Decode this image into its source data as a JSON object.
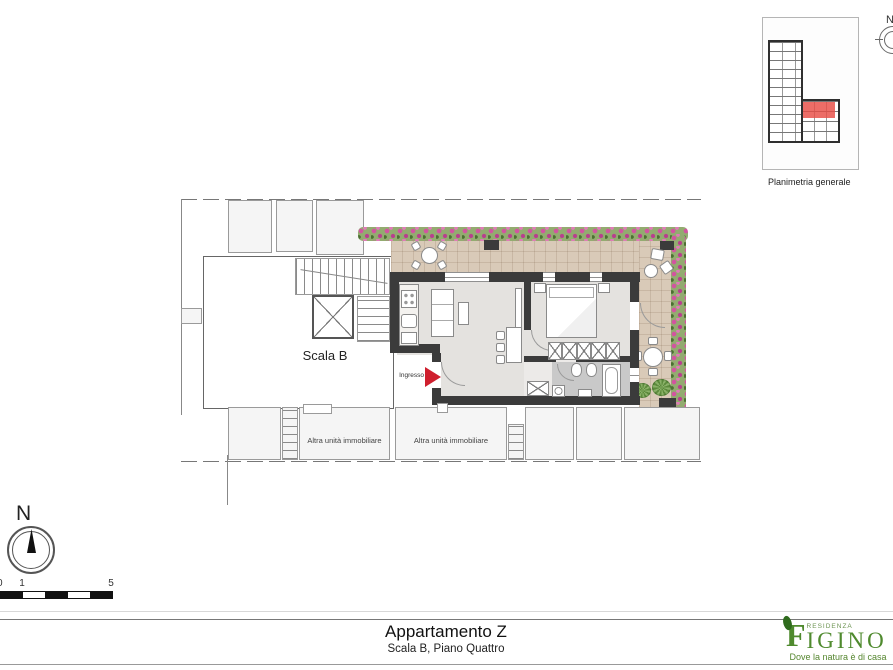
{
  "inset": {
    "caption": "Planimetria generale"
  },
  "plan": {
    "stairwell_label": "Scala B",
    "entrance_label": "Ingresso",
    "other_unit_labels": [
      "Altra unità immobiliare",
      "Altra unità immobiliare"
    ]
  },
  "north_compass": {
    "label": "N"
  },
  "corner_compass": {
    "label": "N"
  },
  "scale_bar": {
    "labels": [
      "0",
      "1",
      "5"
    ]
  },
  "title_block": {
    "title": "Appartamento Z",
    "subtitle": "Scala B, Piano Quattro"
  },
  "logo": {
    "residence": "RESIDENZA",
    "initial": "F",
    "rest": "IGINO",
    "tagline": "Dove la natura è di casa"
  },
  "colors": {
    "wall_dark": "#3b3b3b",
    "terrace_tile": "#d9cab8",
    "flower_pink": "#d254a0",
    "foliage_green": "#93ab70",
    "unit_highlight_red": "#e4534e",
    "logo_green": "#4f8a2e",
    "entrance_arrow_red": "#cf1f2e"
  }
}
